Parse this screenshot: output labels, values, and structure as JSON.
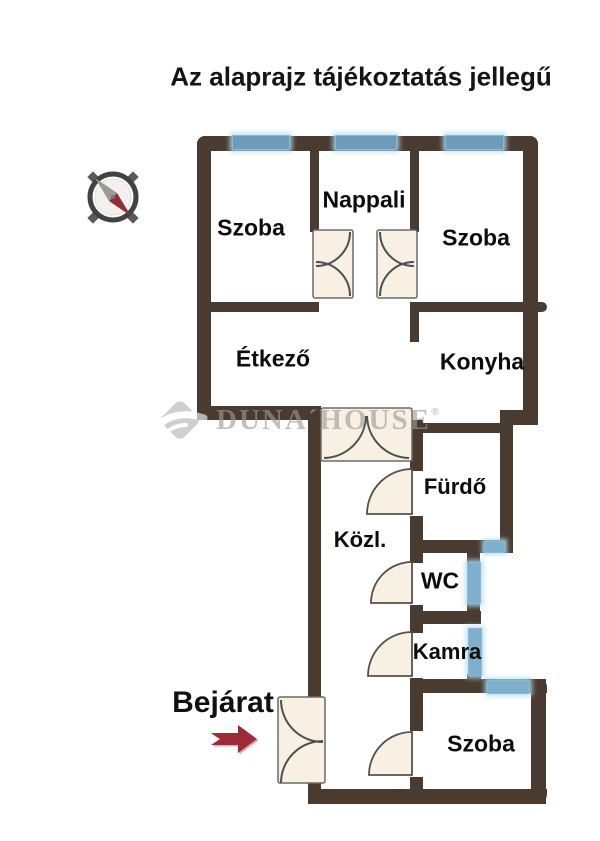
{
  "title": "Az alaprajz tájékoztatás jellegű",
  "entrance": {
    "label": "Bejárat"
  },
  "watermark": {
    "brand": "DUNA´HOUSE",
    "registered": "®"
  },
  "rooms": [
    {
      "id": "szoba-top-left",
      "label": "Szoba"
    },
    {
      "id": "nappali",
      "label": "Nappali"
    },
    {
      "id": "szoba-top-right",
      "label": "Szoba"
    },
    {
      "id": "etkezo",
      "label": "Étkező"
    },
    {
      "id": "konyha",
      "label": "Konyha"
    },
    {
      "id": "furdo",
      "label": "Fürdő"
    },
    {
      "id": "kozlekedo",
      "label": "Közl."
    },
    {
      "id": "wc",
      "label": "WC"
    },
    {
      "id": "kamra",
      "label": "Kamra"
    },
    {
      "id": "szoba-bottom",
      "label": "Szoba"
    }
  ],
  "icons": {
    "compass": "compass-rose",
    "entrance_arrow": "right-arrow"
  },
  "colors": {
    "wall": "#4a3b31",
    "window": "#6d9bb9",
    "window_shaft": "#7eafcd",
    "window_glow": "#b0dbf1",
    "door_fill": "#f7f0e3",
    "door_stroke": "#55504b",
    "arrow_red": "#9d2b38",
    "compass_needle_gray": "#9a9a9a",
    "compass_needle_red": "#8e3038",
    "watermark_gray": "#9b9b9b",
    "text": "#111111",
    "background": "#ffffff"
  }
}
